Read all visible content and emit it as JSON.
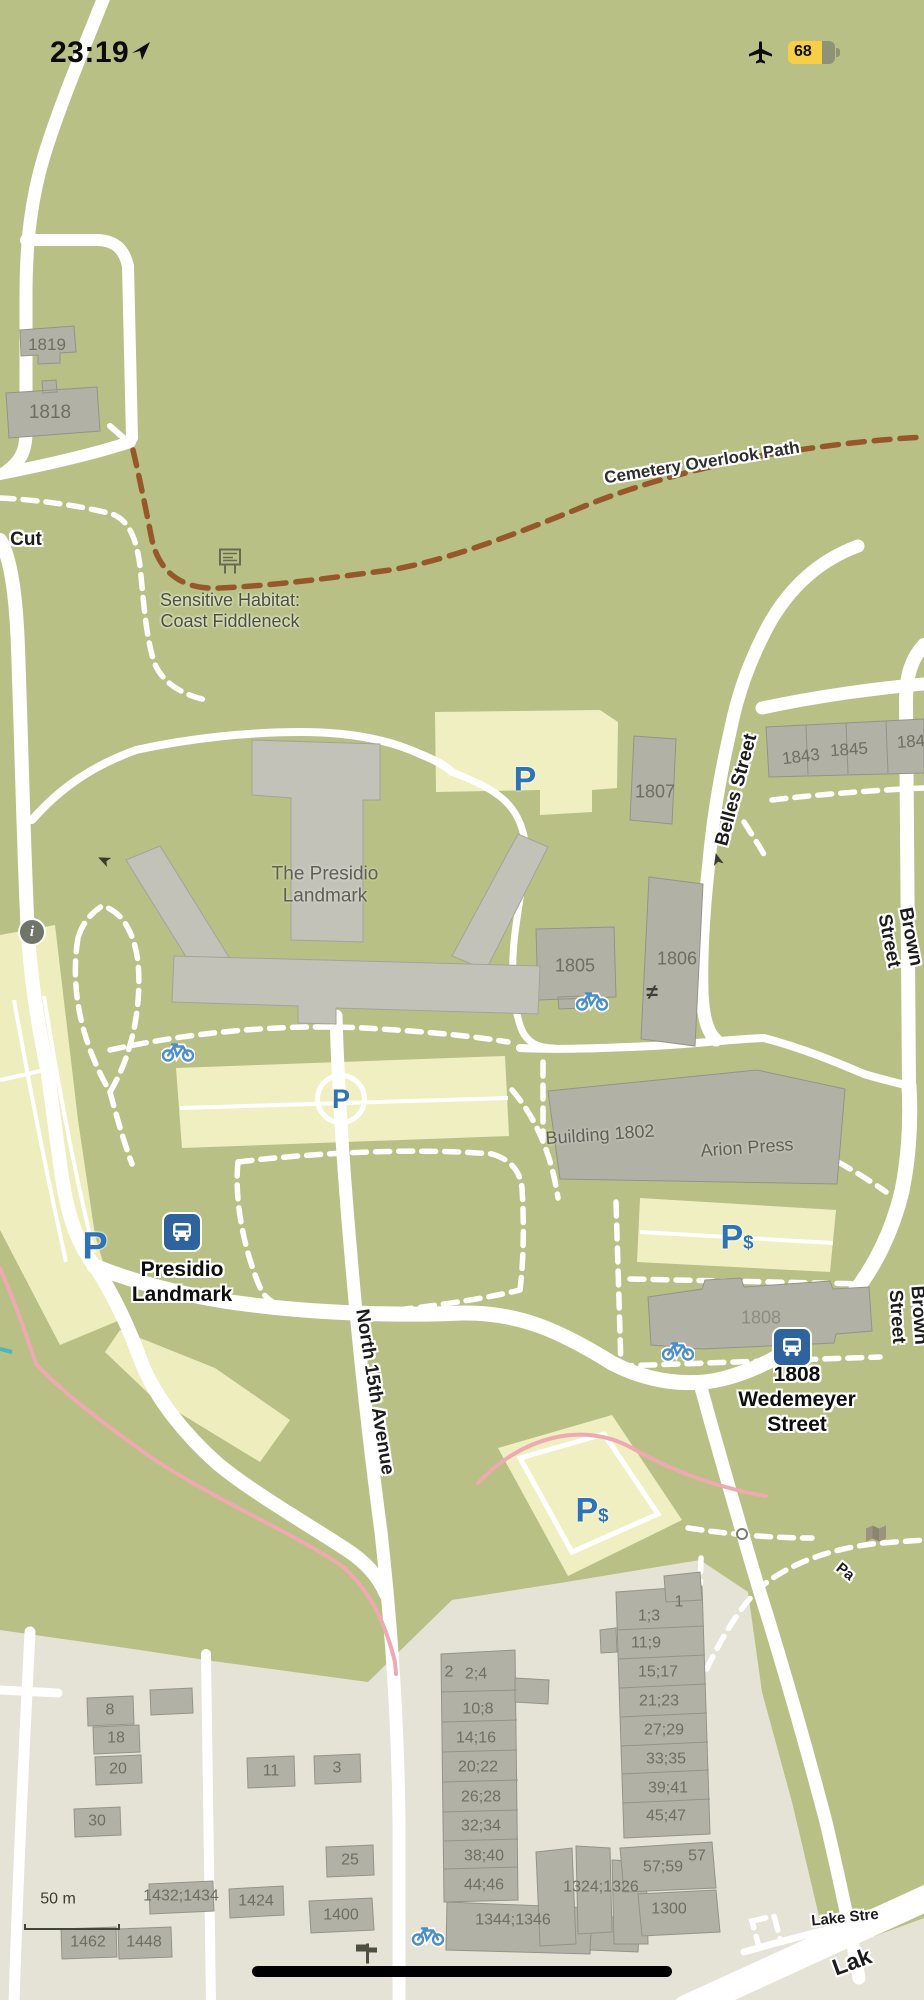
{
  "status_bar": {
    "time": "23:19",
    "battery_level": "68"
  },
  "map": {
    "scale_label": "50 m",
    "icons": {
      "p": "P",
      "dollar": "$",
      "gate": "≠",
      "info": "i"
    },
    "colors": {
      "background": "#b8c086",
      "urban": "#e5e2d6",
      "road": "#ffffff",
      "building": "#b2b1a6",
      "parking_lot": "#f0efc2",
      "trail_brown": "#96582a",
      "bike_route_pink": "#efa9b0",
      "icon_blue": "#2e74b5",
      "battery_yellow": "#f7ce45"
    },
    "labels": [
      {
        "name": "street-label-cut",
        "text": "Cut",
        "x": 26,
        "y": 540,
        "size": 19,
        "cls": "street"
      },
      {
        "name": "path-label-cemetery-overlook",
        "text": "Cemetery Overlook Path",
        "x": 702,
        "y": 463,
        "size": 17,
        "rot": -9,
        "cls": "path"
      },
      {
        "name": "street-label-belles",
        "text": "Belles Street",
        "x": 737,
        "y": 790,
        "size": 19,
        "rot": -75,
        "cls": "street"
      },
      {
        "name": "street-label-brown-1",
        "text": "Brown Street",
        "x": 899,
        "y": 939,
        "size": 19,
        "rot": 79,
        "cls": "street"
      },
      {
        "name": "street-label-brown-2",
        "text": "Brown Street",
        "x": 907,
        "y": 1316,
        "size": 19,
        "rot": 86,
        "cls": "street"
      },
      {
        "name": "street-label-north-15th",
        "text": "North 15th Avenue",
        "x": 374,
        "y": 1392,
        "size": 19,
        "rot": 81,
        "cls": "street"
      },
      {
        "name": "street-label-lake-small",
        "text": "Lake Stre",
        "x": 845,
        "y": 1918,
        "size": 15,
        "rot": -6,
        "cls": "street"
      },
      {
        "name": "street-label-lake-large",
        "text": "Lak",
        "x": 852,
        "y": 1962,
        "size": 23,
        "rot": -20,
        "cls": "street"
      },
      {
        "name": "path-label-pa",
        "text": "Pa",
        "x": 845,
        "y": 1572,
        "size": 15,
        "rot": 38,
        "cls": "street"
      },
      {
        "name": "poi-label-presidio-landmark",
        "text": "Presidio\nLandmark",
        "x": 182,
        "y": 1283,
        "size": 21,
        "cls": "poi",
        "tap": true
      },
      {
        "name": "poi-label-1808-wedemeyer",
        "text": "1808 Wedemeyer\nStreet",
        "x": 797,
        "y": 1400,
        "size": 21,
        "cls": "poi",
        "tap": true
      },
      {
        "name": "area-label-sensitive-habitat",
        "text": "Sensitive Habitat:\nCoast Fiddleneck",
        "x": 230,
        "y": 611,
        "size": 18,
        "cls": "area"
      },
      {
        "name": "building-label-the-presidio-landmark",
        "text": "The Presidio\nLandmark",
        "x": 325,
        "y": 886,
        "size": 19,
        "cls": "bname"
      },
      {
        "name": "building-label-1802",
        "text": "Building 1802",
        "x": 600,
        "y": 1135,
        "size": 18,
        "rot": -4,
        "cls": "bname"
      },
      {
        "name": "building-label-arion-press",
        "text": "Arion Press",
        "x": 747,
        "y": 1148,
        "size": 18,
        "rot": -4,
        "cls": "bname"
      },
      {
        "name": "building-label",
        "text": "1819",
        "x": 47,
        "y": 345,
        "size": 17,
        "cls": "bldg"
      },
      {
        "name": "building-label",
        "text": "1818",
        "x": 50,
        "y": 413,
        "size": 19,
        "cls": "bldg"
      },
      {
        "name": "building-label",
        "text": "1807",
        "x": 655,
        "y": 792,
        "size": 18,
        "cls": "bldg"
      },
      {
        "name": "building-label",
        "text": "1843",
        "x": 801,
        "y": 757,
        "size": 17,
        "rot": -7,
        "cls": "bldg"
      },
      {
        "name": "building-label",
        "text": "1845",
        "x": 849,
        "y": 750,
        "size": 17,
        "rot": -4,
        "cls": "bldg"
      },
      {
        "name": "building-label",
        "text": "184",
        "x": 911,
        "y": 742,
        "size": 17,
        "rot": -4,
        "cls": "bldg"
      },
      {
        "name": "building-label",
        "text": "1805",
        "x": 575,
        "y": 966,
        "size": 18,
        "cls": "bldg"
      },
      {
        "name": "building-label",
        "text": "1806",
        "x": 677,
        "y": 959,
        "size": 18,
        "cls": "bldg"
      },
      {
        "name": "building-label",
        "text": "1808",
        "x": 761,
        "y": 1318,
        "size": 18,
        "cls": "bldg-light"
      },
      {
        "name": "building-label",
        "text": "2",
        "x": 449,
        "y": 1673,
        "size": 16,
        "cls": "bldg"
      },
      {
        "name": "building-label",
        "text": "2;4",
        "x": 476,
        "y": 1675,
        "size": 16,
        "cls": "bldg"
      },
      {
        "name": "building-label",
        "text": "10;8",
        "x": 478,
        "y": 1710,
        "size": 16,
        "cls": "bldg"
      },
      {
        "name": "building-label",
        "text": "14;16",
        "x": 476,
        "y": 1739,
        "size": 16,
        "cls": "bldg"
      },
      {
        "name": "building-label",
        "text": "20;22",
        "x": 478,
        "y": 1768,
        "size": 16,
        "cls": "bldg"
      },
      {
        "name": "building-label",
        "text": "26;28",
        "x": 481,
        "y": 1798,
        "size": 16,
        "cls": "bldg"
      },
      {
        "name": "building-label",
        "text": "32;34",
        "x": 481,
        "y": 1827,
        "size": 16,
        "cls": "bldg"
      },
      {
        "name": "building-label",
        "text": "38;40",
        "x": 484,
        "y": 1857,
        "size": 16,
        "cls": "bldg"
      },
      {
        "name": "building-label",
        "text": "44;46",
        "x": 484,
        "y": 1886,
        "size": 16,
        "cls": "bldg"
      },
      {
        "name": "building-label",
        "text": "1344;1346",
        "x": 513,
        "y": 1921,
        "size": 16,
        "cls": "bldg"
      },
      {
        "name": "building-label",
        "text": "1",
        "x": 679,
        "y": 1603,
        "size": 16,
        "cls": "bldg"
      },
      {
        "name": "building-label",
        "text": "1;3",
        "x": 649,
        "y": 1617,
        "size": 16,
        "cls": "bldg"
      },
      {
        "name": "building-label",
        "text": "11;9",
        "x": 646,
        "y": 1644,
        "size": 16,
        "cls": "bldg"
      },
      {
        "name": "building-label",
        "text": "15;17",
        "x": 658,
        "y": 1673,
        "size": 16,
        "cls": "bldg"
      },
      {
        "name": "building-label",
        "text": "21;23",
        "x": 659,
        "y": 1702,
        "size": 16,
        "cls": "bldg"
      },
      {
        "name": "building-label",
        "text": "27;29",
        "x": 664,
        "y": 1731,
        "size": 16,
        "cls": "bldg"
      },
      {
        "name": "building-label",
        "text": "33;35",
        "x": 666,
        "y": 1760,
        "size": 16,
        "cls": "bldg"
      },
      {
        "name": "building-label",
        "text": "39;41",
        "x": 668,
        "y": 1789,
        "size": 16,
        "cls": "bldg"
      },
      {
        "name": "building-label",
        "text": "45;47",
        "x": 666,
        "y": 1817,
        "size": 16,
        "cls": "bldg"
      },
      {
        "name": "building-label",
        "text": "57;59",
        "x": 663,
        "y": 1868,
        "size": 16,
        "cls": "bldg"
      },
      {
        "name": "building-label",
        "text": "57",
        "x": 697,
        "y": 1857,
        "size": 16,
        "cls": "bldg"
      },
      {
        "name": "building-label",
        "text": "1324;1326",
        "x": 601,
        "y": 1888,
        "size": 16,
        "cls": "bldg"
      },
      {
        "name": "building-label",
        "text": "1300",
        "x": 669,
        "y": 1910,
        "size": 16,
        "cls": "bldg"
      },
      {
        "name": "building-label",
        "text": "8",
        "x": 110,
        "y": 1711,
        "size": 16,
        "cls": "bldg"
      },
      {
        "name": "building-label",
        "text": "18",
        "x": 116,
        "y": 1739,
        "size": 16,
        "cls": "bldg"
      },
      {
        "name": "building-label",
        "text": "20",
        "x": 118,
        "y": 1770,
        "size": 16,
        "cls": "bldg"
      },
      {
        "name": "building-label",
        "text": "30",
        "x": 97,
        "y": 1822,
        "size": 16,
        "cls": "bldg"
      },
      {
        "name": "building-label",
        "text": "3",
        "x": 337,
        "y": 1769,
        "size": 16,
        "cls": "bldg"
      },
      {
        "name": "building-label",
        "text": "11",
        "x": 271,
        "y": 1772,
        "size": 16,
        "cls": "bldg"
      },
      {
        "name": "building-label",
        "text": "25",
        "x": 350,
        "y": 1861,
        "size": 16,
        "cls": "bldg"
      },
      {
        "name": "building-label",
        "text": "1432;1434",
        "x": 181,
        "y": 1897,
        "size": 16,
        "cls": "bldg"
      },
      {
        "name": "building-label",
        "text": "1424",
        "x": 256,
        "y": 1902,
        "size": 16,
        "cls": "bldg"
      },
      {
        "name": "building-label",
        "text": "1400",
        "x": 341,
        "y": 1916,
        "size": 16,
        "cls": "bldg"
      },
      {
        "name": "building-label",
        "text": "1462",
        "x": 88,
        "y": 1943,
        "size": 16,
        "cls": "bldg"
      },
      {
        "name": "building-label",
        "text": "1448",
        "x": 144,
        "y": 1943,
        "size": 16,
        "cls": "bldg"
      },
      {
        "name": "scale-label",
        "text": "50 m",
        "x": 58,
        "y": 1900,
        "size": 16,
        "cls": "scale"
      }
    ]
  }
}
